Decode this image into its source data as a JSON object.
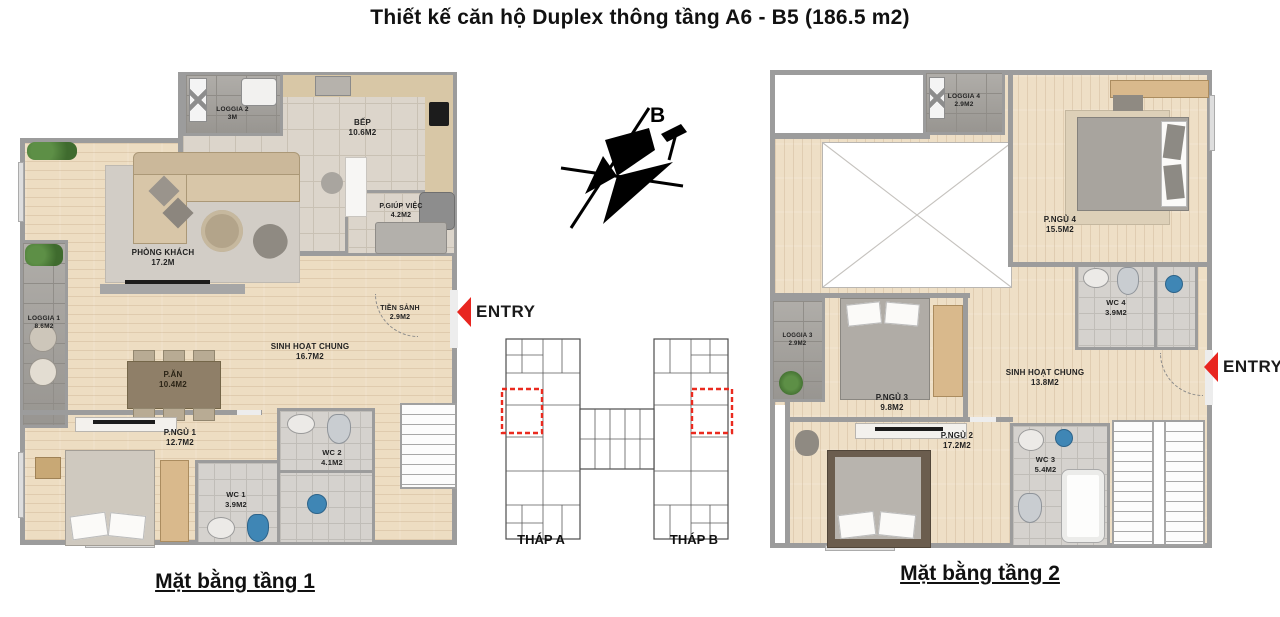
{
  "title": "Thiết kế căn hộ Duplex thông tầng A6 - B5 (186.5 m2)",
  "compass": {
    "label": "B"
  },
  "entry_left": {
    "label": "ENTRY"
  },
  "entry_right": {
    "label": "ENTRY"
  },
  "site_plan": {
    "tower_a_label": "THÁP A",
    "tower_b_label": "THÁP B"
  },
  "floor1": {
    "caption": "Mặt bằng tầng 1",
    "rooms": [
      {
        "name": "PHÒNG KHÁCH",
        "area": "17.2M"
      },
      {
        "name": "BẾP",
        "area": "10.6M2"
      },
      {
        "name": "LOGGIA 2",
        "area": "3M"
      },
      {
        "name": "P.GIÚP VIỆC",
        "area": "4.2M2"
      },
      {
        "name": "LOGGIA 1",
        "area": "8.6M2"
      },
      {
        "name": "P.ĂN",
        "area": "10.4M2"
      },
      {
        "name": "SINH HOẠT CHUNG",
        "area": "16.7M2"
      },
      {
        "name": "TIỀN SẢNH",
        "area": "2.9M2"
      },
      {
        "name": "P.NGỦ 1",
        "area": "12.7M2"
      },
      {
        "name": "WC 1",
        "area": "3.9M2"
      },
      {
        "name": "WC 2",
        "area": "4.1M2"
      }
    ]
  },
  "floor2": {
    "caption": "Mặt bằng tầng 2",
    "rooms": [
      {
        "name": "LOGGIA 4",
        "area": "2.9M2"
      },
      {
        "name": "P.NGỦ 4",
        "area": "15.5M2"
      },
      {
        "name": "WC 4",
        "area": "3.9M2"
      },
      {
        "name": "LOGGIA 3",
        "area": "2.9M2"
      },
      {
        "name": "P.NGỦ 3",
        "area": "9.8M2"
      },
      {
        "name": "SINH HOẠT CHUNG",
        "area": "13.8M2"
      },
      {
        "name": "P.NGỦ 2",
        "area": "17.2M2"
      },
      {
        "name": "WC 3",
        "area": "5.4M2"
      }
    ]
  },
  "colors": {
    "accent_red": "#e8251f",
    "wall_gray": "#9c9c9c",
    "wood_floor": "#edddc2",
    "tile_floor": "#dcd5cb",
    "stone_loggia": "#a5a29d"
  }
}
